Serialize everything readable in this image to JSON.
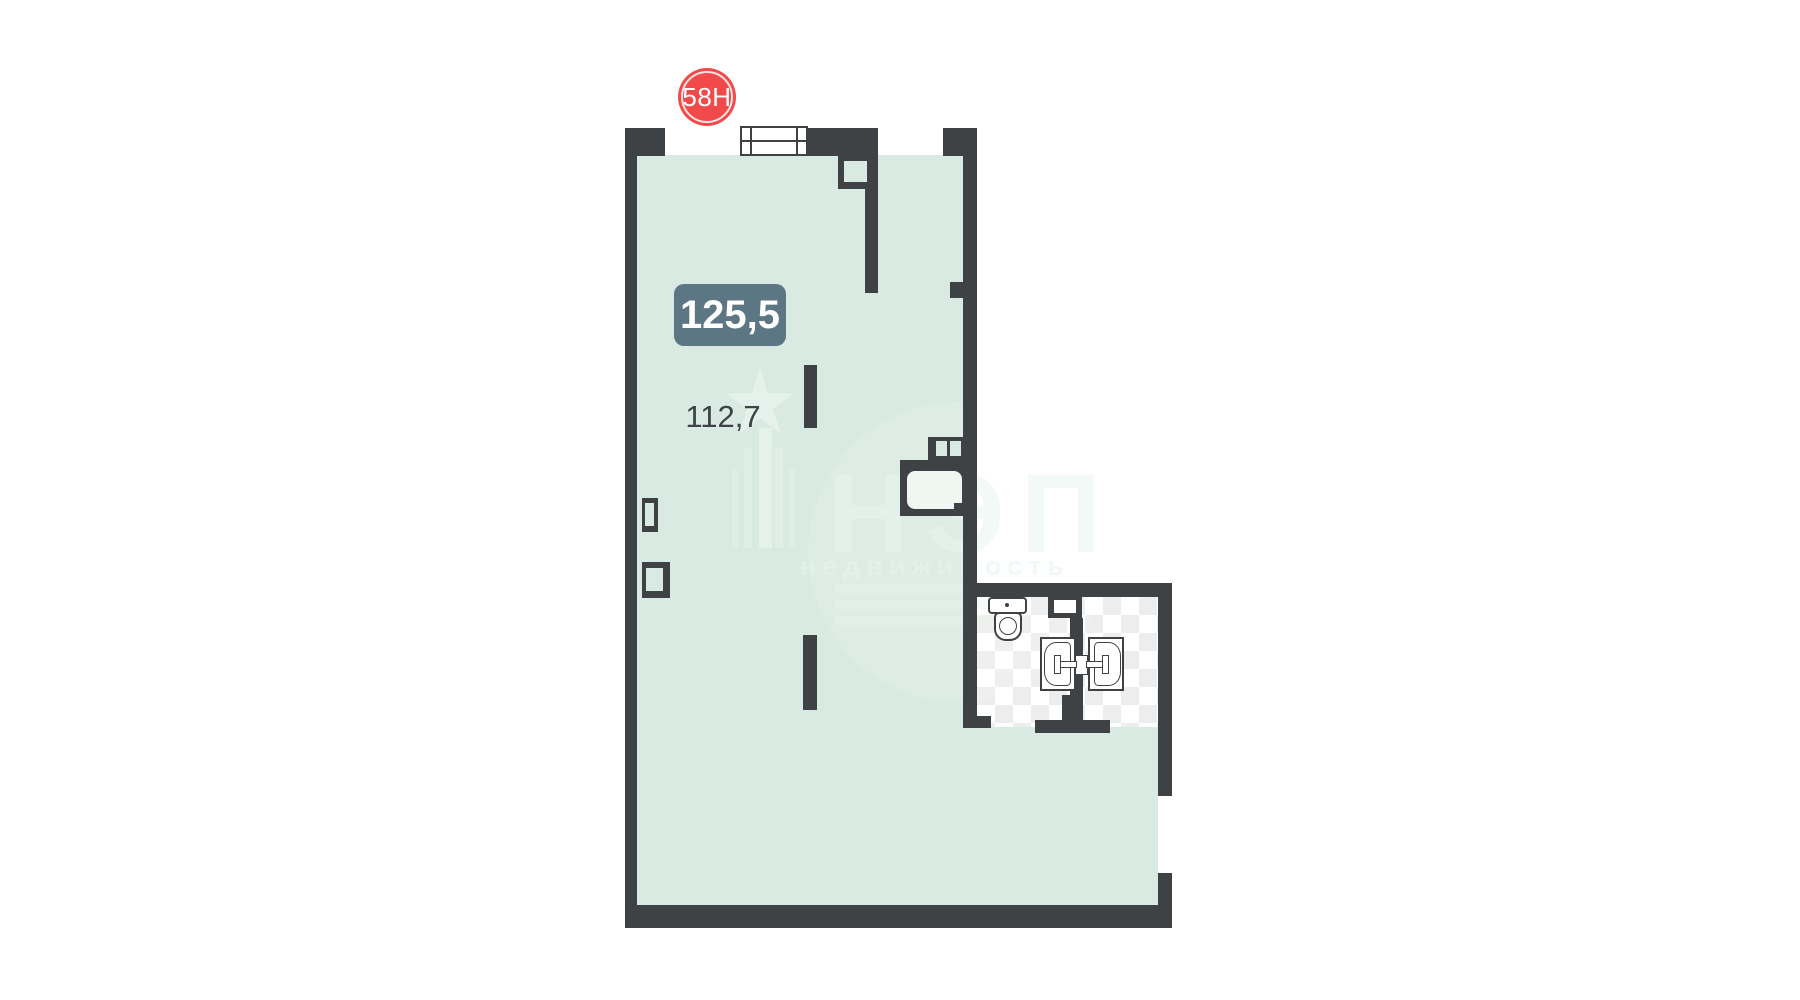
{
  "unit_badge": {
    "label": "58Н"
  },
  "area_labels": {
    "total": "125,5",
    "room": "112,7"
  },
  "watermark": {
    "brand": "НЭП",
    "subtitle": "недвижимость"
  },
  "colors": {
    "wall": "#3e4245",
    "floor": "#d8eae2",
    "tile": "#ededed",
    "fixture-line": "#3e4245",
    "badge": "#f24a4a",
    "area-label-bg": "#5d7683",
    "area-text": "#3b4347"
  }
}
